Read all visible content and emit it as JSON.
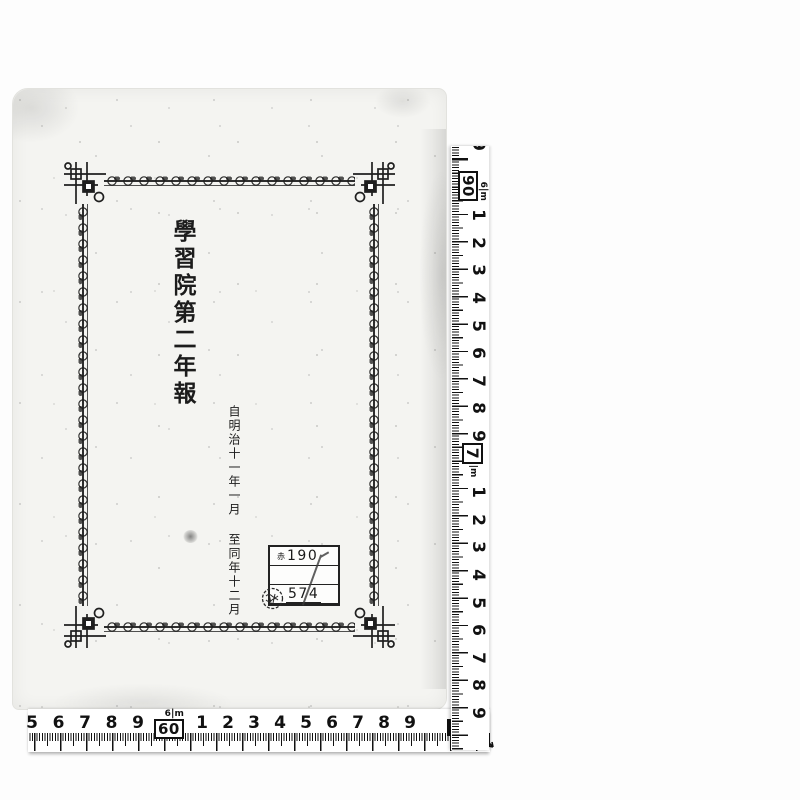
{
  "document": {
    "title_vertical": "學習院第二年報",
    "date_from": "自明治十一年一月",
    "date_to": "至同年十二月",
    "label": {
      "category": "赤",
      "upper_number": "190",
      "lower_number": "574"
    }
  },
  "rulers": {
    "vertical": {
      "top_partial_digit": "9",
      "dm_label_meter": "6",
      "dm_label_unit": "m",
      "dm_label_value": "90",
      "upper_cm_digits": [
        "1",
        "2",
        "3",
        "4",
        "5",
        "6",
        "7",
        "8",
        "9"
      ],
      "meter_label_value": "7",
      "meter_label_unit": "m",
      "lower_cm_digits": [
        "1",
        "2",
        "3",
        "4",
        "5",
        "6",
        "7",
        "8",
        "9"
      ]
    },
    "horizontal": {
      "left_cm_digits": [
        "5",
        "6",
        "7",
        "8",
        "9"
      ],
      "dm_label_meter": "6",
      "dm_label_unit": "m",
      "dm_label_value": "60",
      "right_cm_digits": [
        "1",
        "2",
        "3",
        "4",
        "5",
        "6",
        "7",
        "8",
        "9"
      ],
      "end_label_meter": "6",
      "end_label_value": "7"
    }
  },
  "colors": {
    "ink": "#1a1a1a",
    "paper": "#f4f4f1",
    "tape": "#ffffff"
  }
}
